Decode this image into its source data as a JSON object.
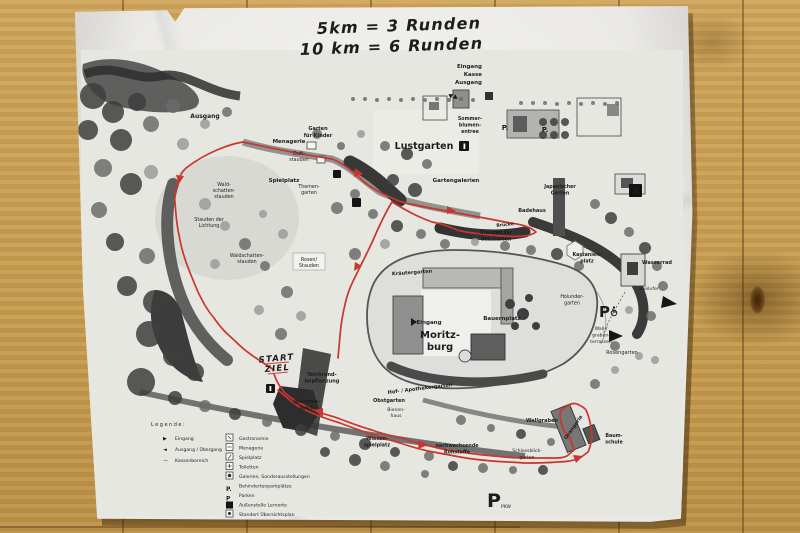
{
  "photo": {
    "handwriting": {
      "line1": "5km  =  3 Runden",
      "line2": "10 km  =  6 Runden",
      "ink_color": "#d23f38"
    }
  },
  "map": {
    "entrance_sign": {
      "line1": "Eingang",
      "line2": "Kasse",
      "line3": "Ausgang",
      "markers": "▼▲"
    },
    "areas": {
      "ausgang": [
        "Ausgang"
      ],
      "menagerie": [
        "Menagerie"
      ],
      "garten_fuer_kinder": [
        "Garten",
        "für Kinder"
      ],
      "duftstauden": [
        "Duft-",
        "stauden"
      ],
      "spielplatz": [
        "Spielplatz"
      ],
      "waldschattenstauden_nord": [
        "Wald-",
        "schatten-",
        "stauden"
      ],
      "themengarten": [
        "Themen-",
        "garten"
      ],
      "stauden_der_lichtung": [
        "Stauden der",
        "Lichtung"
      ],
      "waldschattenstauden_sued": [
        "Waldschatten-",
        "stauden"
      ],
      "rosen_stauden": [
        "Rosen/",
        "Stauden"
      ],
      "lustgarten": [
        "Lustgarten"
      ],
      "sommerblumenentree": [
        "Sommer-",
        "blumen-",
        "entree"
      ],
      "gartengalerien": [
        "Gartengalerien"
      ],
      "japanischer_garten": [
        "Japanischer",
        "Garten"
      ],
      "badehaus": [
        "Badehaus"
      ],
      "bruecke": [
        "Brücke"
      ],
      "stauden_fuer_den_garten": [
        "Stauden für",
        "den Garten"
      ],
      "kastanienplatz": [
        "Kastanien-",
        "platz"
      ],
      "wasserrad": [
        "Wasserrad"
      ],
      "steilufer": [
        "Steilufer"
      ],
      "kraeutergarten": [
        "Kräutergarten"
      ],
      "schloss_eingang": [
        "Eingang"
      ],
      "moritzburg": [
        "Moritz-",
        "burg"
      ],
      "bauernplatz": [
        "Bauernplatz"
      ],
      "hof_apothekergarten": [
        "Hof- / Apothekergarten"
      ],
      "holundergarten": [
        "Holunder-",
        "garten"
      ],
      "wallgraben_terrassen": [
        "Wall-/",
        "graben-",
        "terrassen"
      ],
      "rosengarten": [
        "Rosengarten"
      ],
      "teichrandbepflanzung": [
        "Teichrand-",
        "bepflanzung"
      ],
      "johannisteich": [
        "Johannis-",
        "teich"
      ],
      "obstgarten": [
        "Obstgarten"
      ],
      "bienenhaus": [
        "Bienen-",
        "haus"
      ],
      "wiesenspielplatz": [
        "Wiesen-",
        "spielplatz"
      ],
      "nachwachsende_rohstoffe": [
        "nachwachsende",
        "Rohstoffe"
      ],
      "schlossblickgarten": [
        "Schlossblick-",
        "garten"
      ],
      "wallgraben": [
        "Wallgraben"
      ],
      "baumschule": [
        "Baum-",
        "schule"
      ],
      "orangerie": [
        "Orangerie"
      ]
    },
    "parking": {
      "p_small_1": "P.",
      "p_small_2": "P.",
      "p_disabled": "P",
      "p_pkw": "P",
      "p_pkw_sub": "PKW"
    },
    "facility_letter_a": "A"
  },
  "route": {
    "color": "#c9362e",
    "start_line1": "START",
    "start_line2": "ZIEL"
  },
  "legend": {
    "title": "Legende:",
    "left": [
      {
        "icon": "▶",
        "label": "Eingang"
      },
      {
        "icon": "◄",
        "label": "Ausgang / Übergang"
      },
      {
        "icon": "—",
        "label": "Kassenbereich"
      }
    ],
    "right": [
      {
        "label": "Gastronomie"
      },
      {
        "label": "Menagerie"
      },
      {
        "label": "Spielplatz"
      },
      {
        "label": "Toiletten"
      },
      {
        "label": "Galerien, Sonderausstellungen"
      },
      {
        "label": "Behindertenparkplätze"
      },
      {
        "label": "Parken"
      },
      {
        "label": "Außenstelle Lernorte"
      },
      {
        "label": "Standort Übersichtsplan"
      }
    ],
    "right_icons": {
      "p_dot": "P.",
      "p": "P",
      "a": "A"
    }
  }
}
